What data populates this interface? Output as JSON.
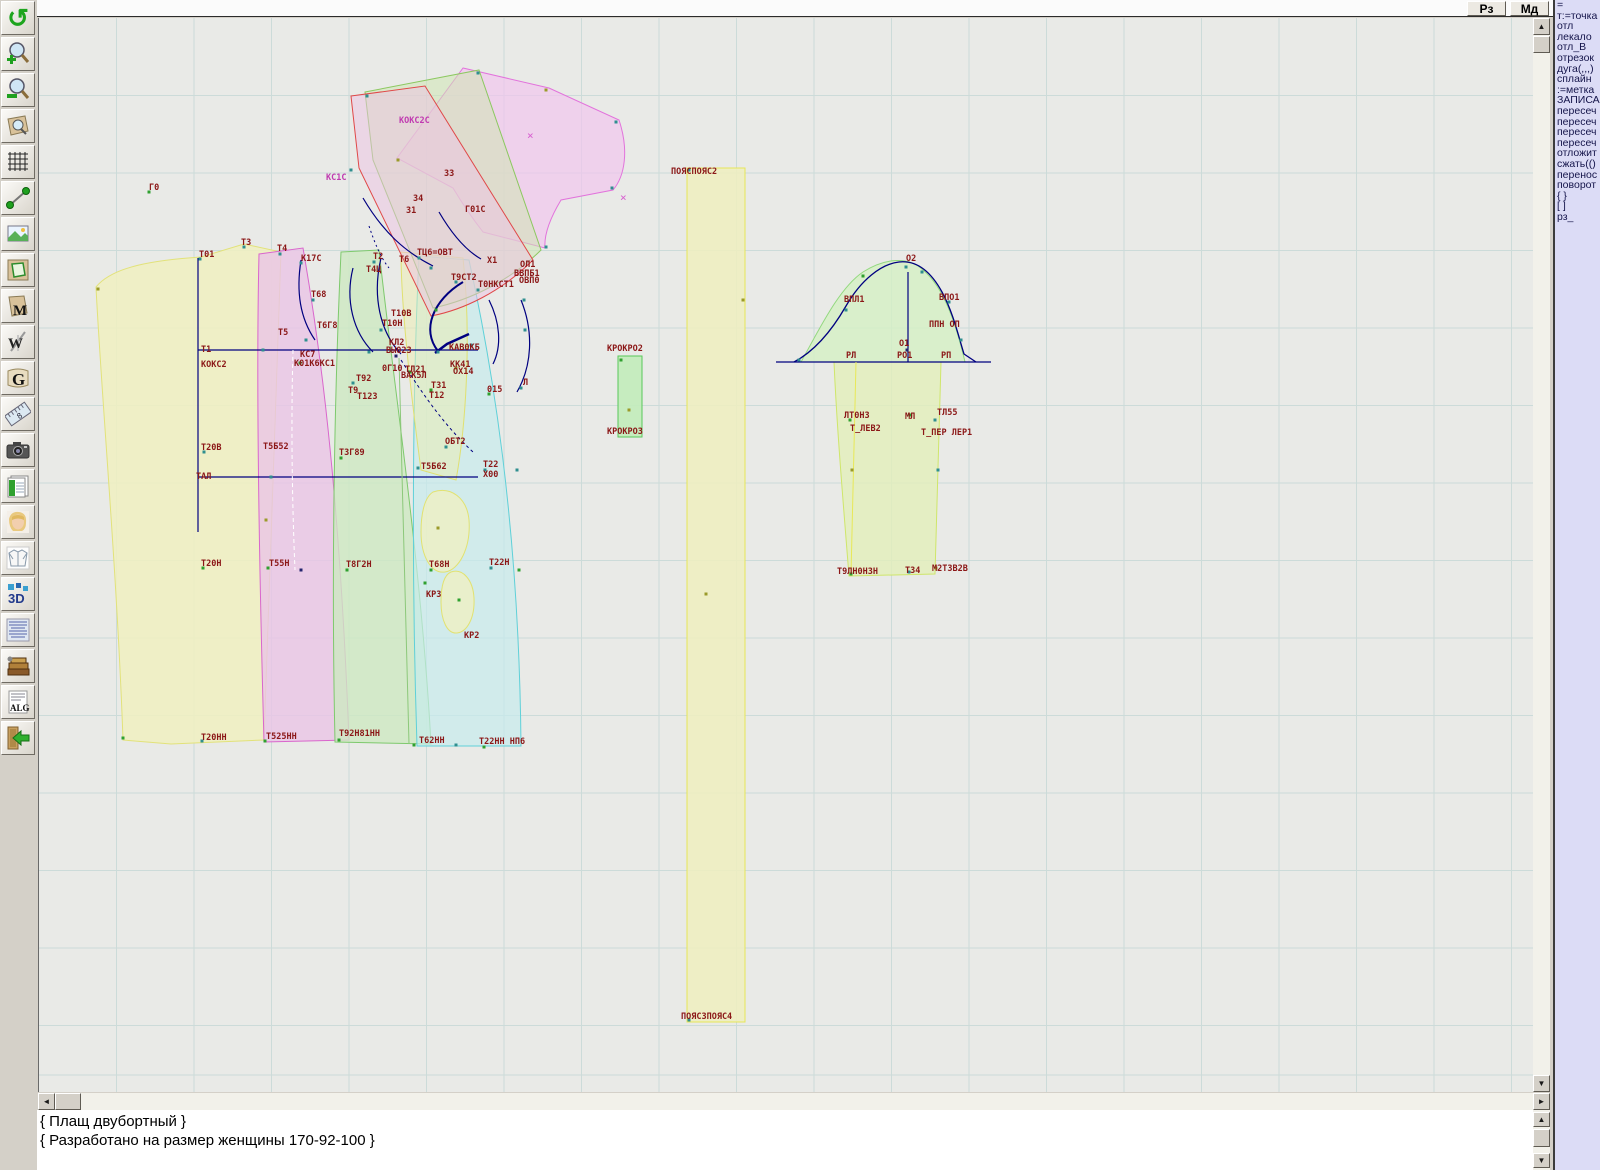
{
  "topbar": {
    "buttons": [
      {
        "label": "Рз"
      },
      {
        "label": "Мд"
      }
    ]
  },
  "toolbar": {
    "glyphs": {
      "undo": "↺",
      "m": "M",
      "w": "W",
      "g": "G",
      "eight": "8",
      "threed": "3D",
      "alg": "ALG"
    },
    "items": [
      "undo-rotate",
      "zoom-in",
      "zoom-out",
      "zoom-piece",
      "grid",
      "measure-segment",
      "image-view",
      "piece-outline",
      "piece-m",
      "compass-w",
      "scroll-g",
      "ruler",
      "camera",
      "spreadsheet",
      "portrait",
      "garment",
      "view-3d",
      "text-list",
      "books",
      "alg-document",
      "exit"
    ]
  },
  "sidebar": {
    "items": [
      "=",
      "т:=точка",
      "отл",
      "лекало",
      "отл_В",
      "отрезок",
      "дуга(,,,)",
      "сплайн",
      ":=метка",
      "ЗАПИСА",
      "пересеч",
      "пересеч",
      "пересеч",
      "пересеч",
      "отложит",
      "сжать(()",
      "перенос",
      "поворот",
      "{ }",
      "[ ]",
      "рз_"
    ]
  },
  "console": {
    "lines": [
      "{ Плащ двубортный }",
      "{ Разработано на размер женщины 170-92-100 }"
    ]
  },
  "canvas": {
    "offset": [
      38,
      18
    ],
    "size": [
      1495,
      1074
    ],
    "grid": {
      "spacing": 77.5,
      "color": "#ccdbd9"
    },
    "label_color": "#8b1717",
    "accent_magenta": "#c03ab0",
    "pieces": [
      {
        "name": "back-yellow",
        "path": "M95,287 C112,266 155,260 200,257 L243,244 L280,252 C274,400 268,560 263,740 L170,744 L122,740 C116,570 100,390 95,287 Z",
        "fill": "#f0f0bf",
        "stroke": "#e2e27a",
        "op": 0.85
      },
      {
        "name": "front-pink",
        "path": "M258,254 L302,248 C318,340 338,480 348,740 L263,742 C258,560 255,380 258,254 Z",
        "fill": "#eac4e6",
        "stroke": "#d966cc",
        "op": 0.8
      },
      {
        "name": "panel-green",
        "path": "M340,252 L378,250 C392,380 420,560 430,744 L334,742 C330,560 334,380 340,252 Z",
        "fill": "#cde9c2",
        "stroke": "#7ec96d",
        "op": 0.8
      },
      {
        "name": "panel-cyan",
        "path": "M418,256 L468,260 C490,360 518,520 520,746 L416,746 C410,560 412,380 418,256 Z",
        "fill": "#c6ebec",
        "stroke": "#5fd0d8",
        "op": 0.7
      },
      {
        "name": "overlay-yellow",
        "path": "M400,252 L462,258 C470,330 466,420 455,480 L420,470 C408,380 400,300 400,252 Z",
        "fill": "#eeeeb0",
        "stroke": "#e0e070",
        "op": 0.5
      },
      {
        "name": "pocket-upper",
        "path": "M432,492 C450,486 466,498 468,520 C470,548 458,570 444,572 C430,574 420,556 420,532 C420,512 424,497 432,492 Z",
        "fill": "#f0f0c0",
        "stroke": "#e2e270",
        "op": 0.75
      },
      {
        "name": "pocket-lower",
        "path": "M450,572 C462,568 472,580 473,598 C474,618 466,632 456,633 C446,634 440,620 440,602 C440,586 443,575 450,572 Z",
        "fill": "#f0f0c0",
        "stroke": "#e2e270",
        "op": 0.75
      },
      {
        "name": "collar-pink-fan",
        "path": "M462,68 L548,88 L618,120 C628,150 624,176 612,190 L560,200 C548,220 543,236 544,248 L482,232 C468,214 458,198 452,188 L396,158 Z",
        "fill": "#f1c6ee",
        "stroke": "#e273dc",
        "op": 0.7
      },
      {
        "name": "collar-green",
        "path": "M364,92 L478,70 L540,250 C510,280 470,300 432,308 L372,160 Z",
        "fill": "#cfe6b4",
        "stroke": "#8cc860",
        "op": 0.55
      },
      {
        "name": "collar-pink-red",
        "path": "M350,96 L424,86 L532,260 C500,292 462,310 430,316 L358,168 Z",
        "fill": "#eec2e4",
        "stroke": "#e04848",
        "op": 0.5
      },
      {
        "name": "belt-strip",
        "path": "M686,168 L744,168 L744,1022 L686,1022 Z",
        "fill": "#efefbe",
        "stroke": "#e6e658",
        "op": 0.85
      },
      {
        "name": "kro-strip",
        "path": "M617,356 L641,356 L641,437 L617,437 Z",
        "fill": "#c2ecba",
        "stroke": "#58c858",
        "op": 0.9
      },
      {
        "name": "sleeve-cap",
        "path": "M800,362 C818,330 838,288 862,272 C884,258 908,256 922,270 C944,288 956,328 964,362 Z",
        "fill": "#d4f0c4",
        "stroke": "#92d87e",
        "op": 0.8
      },
      {
        "name": "sleeve-body",
        "path": "M833,362 L940,362 C938,430 936,500 934,574 L848,576 C842,500 836,430 833,362 Z",
        "fill": "#e2efba",
        "stroke": "#cfe66a",
        "op": 0.8
      }
    ],
    "lines": [
      {
        "path": "M197,258 L197,532",
        "s": "#000080",
        "w": 1.2
      },
      {
        "path": "M197,350 L477,350",
        "s": "#000080",
        "w": 1.2
      },
      {
        "path": "M197,477 L477,477",
        "s": "#000080",
        "w": 1.2
      },
      {
        "path": "M300,260 C295,292 299,318 314,340",
        "s": "#000080",
        "w": 1.2
      },
      {
        "path": "M352,268 C344,300 352,332 372,352",
        "s": "#000080",
        "w": 1.2
      },
      {
        "path": "M380,258 C371,296 379,332 400,354",
        "s": "#000080",
        "w": 1.2
      },
      {
        "path": "M462,282 C432,300 420,330 437,351",
        "s": "#000080",
        "w": 2
      },
      {
        "path": "M468,334 L446,344 L434,353",
        "s": "#000080",
        "w": 2.5
      },
      {
        "path": "M488,300 C499,322 501,346 492,364",
        "s": "#000080",
        "w": 1.2
      },
      {
        "path": "M520,300 C533,332 531,366 516,392",
        "s": "#000080",
        "w": 1.2
      },
      {
        "path": "M400,360 C424,398 446,428 472,452",
        "s": "#000080",
        "w": 1,
        "d": "3,3"
      },
      {
        "path": "M362,198 C382,232 404,252 432,266",
        "s": "#000080",
        "w": 1.2
      },
      {
        "path": "M438,212 C452,236 466,251 480,259",
        "s": "#000080",
        "w": 1.2
      },
      {
        "path": "M368,226 C374,244 380,258 388,268",
        "s": "#000080",
        "w": 1,
        "d": "2,3"
      },
      {
        "path": "M775,362 L990,362",
        "s": "#000080",
        "w": 1.2
      },
      {
        "path": "M907,272 L907,362",
        "s": "#000080",
        "w": 1.2
      },
      {
        "path": "M793,362 C812,352 830,332 845,306 C860,280 880,264 898,262 C916,260 930,272 941,292 C952,312 958,338 963,354 L975,362",
        "s": "#000080",
        "w": 1.3
      },
      {
        "path": "M855,362 C853,440 851,510 850,575",
        "s": "#e8e858",
        "w": 1
      },
      {
        "path": "M292,350 C290,420 291,500 294,570",
        "s": "#ffffff",
        "w": 1,
        "d": "4,3"
      },
      {
        "path": "M398,358 C400,440 404,560 408,744",
        "s": "#8cc87a",
        "w": 1
      },
      {
        "path": "M38,1075 L1533,1075",
        "s": "#ccdbd9",
        "w": 1
      }
    ],
    "labels": [
      [
        148,
        190,
        "Г0"
      ],
      [
        198,
        257,
        "Т01"
      ],
      [
        240,
        245,
        "Т3"
      ],
      [
        276,
        251,
        "Т4"
      ],
      [
        300,
        261,
        "К17С"
      ],
      [
        325,
        180,
        "КС1С",
        "#c03ab0"
      ],
      [
        398,
        123,
        "КОКС2С",
        "#c03ab0"
      ],
      [
        443,
        176,
        "З3"
      ],
      [
        412,
        201,
        "З4"
      ],
      [
        405,
        213,
        "З1"
      ],
      [
        464,
        212,
        "Г01С"
      ],
      [
        372,
        259,
        "Т2"
      ],
      [
        398,
        262,
        "Т6"
      ],
      [
        416,
        255,
        "ТЦ6=ОВТ"
      ],
      [
        365,
        272,
        "Т4Ц"
      ],
      [
        486,
        263,
        "Х1"
      ],
      [
        519,
        267,
        "ОЛ1"
      ],
      [
        513,
        276,
        "ВВПБ1"
      ],
      [
        518,
        283,
        "ОВП0"
      ],
      [
        450,
        280,
        "Т9СТ2"
      ],
      [
        477,
        287,
        "Т0НКСТ1"
      ],
      [
        310,
        297,
        "Т68"
      ],
      [
        316,
        328,
        "Т6Г8"
      ],
      [
        277,
        335,
        "Т5"
      ],
      [
        390,
        316,
        "Т10В"
      ],
      [
        381,
        326,
        "Т10Н"
      ],
      [
        200,
        352,
        "Т1"
      ],
      [
        200,
        367,
        "КОКС2"
      ],
      [
        299,
        357,
        "КС7"
      ],
      [
        293,
        366,
        "К01К6КС1"
      ],
      [
        388,
        345,
        "КЛ2"
      ],
      [
        385,
        353,
        "ВЫ023"
      ],
      [
        381,
        371,
        "0Г10"
      ],
      [
        404,
        372,
        "ТЛ21"
      ],
      [
        400,
        378,
        "ВАК5Л"
      ],
      [
        448,
        350,
        "КАВ0КБ"
      ],
      [
        449,
        367,
        "КК41"
      ],
      [
        452,
        374,
        "ОХ14"
      ],
      [
        430,
        388,
        "Т31"
      ],
      [
        428,
        398,
        "Т12"
      ],
      [
        486,
        392,
        "015"
      ],
      [
        522,
        385,
        "Л"
      ],
      [
        355,
        381,
        "Т92"
      ],
      [
        347,
        393,
        "Т9"
      ],
      [
        356,
        399,
        "Т123"
      ],
      [
        606,
        351,
        "КРОКРО2"
      ],
      [
        606,
        434,
        "КРОКРО3"
      ],
      [
        670,
        174,
        "ПОЯСПОЯС2"
      ],
      [
        680,
        1019,
        "ПОЯСЗПОЯС4"
      ],
      [
        200,
        450,
        "Т20В"
      ],
      [
        262,
        449,
        "Т5Б52"
      ],
      [
        338,
        455,
        "ТЗГ89"
      ],
      [
        444,
        444,
        "ОБТ2"
      ],
      [
        420,
        469,
        "Т5Б62"
      ],
      [
        482,
        467,
        "Т22"
      ],
      [
        482,
        477,
        "Х00"
      ],
      [
        195,
        479,
        "ТАЛ"
      ],
      [
        200,
        566,
        "Т20Н"
      ],
      [
        268,
        566,
        "Т55Н"
      ],
      [
        345,
        567,
        "Т8Г2Н"
      ],
      [
        428,
        567,
        "Т68Н"
      ],
      [
        488,
        565,
        "Т22Н"
      ],
      [
        425,
        597,
        "КР3"
      ],
      [
        463,
        638,
        "КР2"
      ],
      [
        200,
        740,
        "Т20НН"
      ],
      [
        265,
        739,
        "Т525НН"
      ],
      [
        338,
        736,
        "Т92Н81НН"
      ],
      [
        418,
        743,
        "Т62НН"
      ],
      [
        478,
        744,
        "Т22НН НП6"
      ],
      [
        905,
        261,
        "О2"
      ],
      [
        843,
        302,
        "ВПЛ1"
      ],
      [
        938,
        300,
        "ВПО1"
      ],
      [
        928,
        327,
        "ППН ОП"
      ],
      [
        898,
        346,
        "О1"
      ],
      [
        845,
        358,
        "РЛ"
      ],
      [
        896,
        358,
        "РО1"
      ],
      [
        940,
        358,
        "РП"
      ],
      [
        843,
        418,
        "ЛТ0Н3"
      ],
      [
        849,
        431,
        "Т_ЛЕВ2"
      ],
      [
        904,
        419,
        "МЛ"
      ],
      [
        936,
        415,
        "ТЛ55"
      ],
      [
        920,
        435,
        "Т_ПЕР ЛЕР1"
      ],
      [
        836,
        574,
        "Т9ЛН0Н3Н"
      ],
      [
        904,
        573,
        "ТЗ4"
      ],
      [
        931,
        571,
        "М2ТЗВ2В"
      ]
    ],
    "crosses": [
      [
        530,
        135
      ],
      [
        623,
        197
      ]
    ],
    "markers": [
      [
        148,
        192,
        "g"
      ],
      [
        199,
        259,
        "t"
      ],
      [
        243,
        247,
        "t"
      ],
      [
        279,
        254,
        "t"
      ],
      [
        300,
        263,
        "t"
      ],
      [
        97,
        289,
        "o"
      ],
      [
        122,
        738,
        "g"
      ],
      [
        201,
        741,
        "t"
      ],
      [
        264,
        741,
        "g"
      ],
      [
        265,
        520,
        "o"
      ],
      [
        262,
        350,
        "t"
      ],
      [
        270,
        477,
        "t"
      ],
      [
        305,
        340,
        "t"
      ],
      [
        312,
        300,
        "t"
      ],
      [
        299,
        363,
        "g"
      ],
      [
        352,
        383,
        "t"
      ],
      [
        368,
        352,
        "t"
      ],
      [
        380,
        330,
        "t"
      ],
      [
        395,
        356,
        "n"
      ],
      [
        409,
        372,
        "g"
      ],
      [
        430,
        390,
        "g"
      ],
      [
        437,
        352,
        "t"
      ],
      [
        455,
        368,
        "o"
      ],
      [
        470,
        345,
        "t"
      ],
      [
        488,
        394,
        "g"
      ],
      [
        520,
        388,
        "t"
      ],
      [
        524,
        330,
        "t"
      ],
      [
        455,
        282,
        "t"
      ],
      [
        477,
        290,
        "t"
      ],
      [
        430,
        268,
        "t"
      ],
      [
        373,
        262,
        "t"
      ],
      [
        418,
        258,
        "t"
      ],
      [
        350,
        170,
        "t"
      ],
      [
        366,
        96,
        "t"
      ],
      [
        477,
        73,
        "t"
      ],
      [
        545,
        90,
        "o"
      ],
      [
        615,
        122,
        "t"
      ],
      [
        611,
        188,
        "t"
      ],
      [
        545,
        247,
        "t"
      ],
      [
        397,
        160,
        "o"
      ],
      [
        435,
        310,
        "g"
      ],
      [
        417,
        468,
        "t"
      ],
      [
        424,
        583,
        "g"
      ],
      [
        437,
        528,
        "o"
      ],
      [
        458,
        600,
        "g"
      ],
      [
        620,
        360,
        "g"
      ],
      [
        628,
        410,
        "o"
      ],
      [
        688,
        170,
        "t"
      ],
      [
        742,
        300,
        "o"
      ],
      [
        705,
        594,
        "o"
      ],
      [
        688,
        1020,
        "t"
      ],
      [
        798,
        360,
        "t"
      ],
      [
        845,
        310,
        "t"
      ],
      [
        862,
        276,
        "g"
      ],
      [
        905,
        267,
        "t"
      ],
      [
        921,
        272,
        "t"
      ],
      [
        948,
        302,
        "t"
      ],
      [
        960,
        340,
        "t"
      ],
      [
        906,
        350,
        "n"
      ],
      [
        849,
        420,
        "g"
      ],
      [
        909,
        415,
        "g"
      ],
      [
        934,
        420,
        "t"
      ],
      [
        850,
        574,
        "g"
      ],
      [
        908,
        572,
        "t"
      ],
      [
        935,
        568,
        "o"
      ],
      [
        937,
        470,
        "t"
      ],
      [
        851,
        470,
        "o"
      ],
      [
        300,
        570,
        "n"
      ],
      [
        267,
        568,
        "g"
      ],
      [
        346,
        570,
        "g"
      ],
      [
        430,
        570,
        "g"
      ],
      [
        490,
        568,
        "t"
      ],
      [
        202,
        568,
        "g"
      ],
      [
        203,
        452,
        "t"
      ],
      [
        340,
        458,
        "g"
      ],
      [
        445,
        447,
        "t"
      ],
      [
        484,
        470,
        "t"
      ],
      [
        413,
        745,
        "g"
      ],
      [
        455,
        745,
        "t"
      ],
      [
        483,
        747,
        "g"
      ],
      [
        338,
        740,
        "g"
      ],
      [
        523,
        300,
        "t"
      ],
      [
        516,
        470,
        "t"
      ],
      [
        518,
        570,
        "g"
      ]
    ],
    "marker_colors": {
      "t": "#2f8f8f",
      "g": "#2fa02f",
      "o": "#9a9a2a",
      "n": "#24246e"
    }
  }
}
